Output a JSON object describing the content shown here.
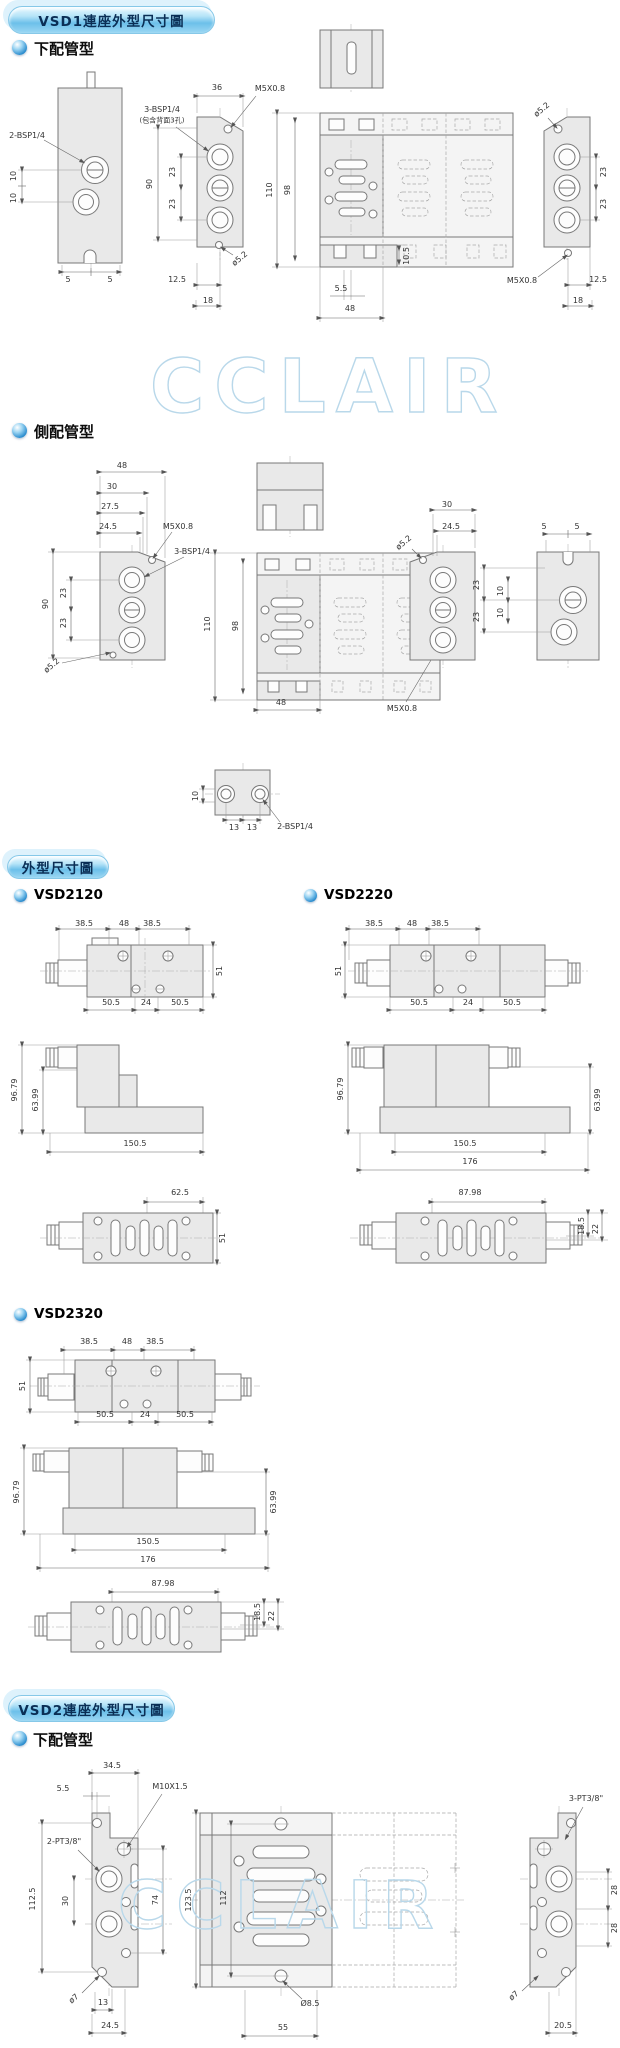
{
  "wm": "CCLAIR",
  "s1": {
    "title": "VSD1連座外型尺寸圖",
    "t_bottom": "下配管型",
    "t_side": "側配管型"
  },
  "s2": {
    "title": "外型尺寸圖",
    "m2120": "VSD2120",
    "m2220": "VSD2220",
    "m2320": "VSD2320"
  },
  "s3": {
    "title": "VSD2連座外型尺寸圖",
    "t_bottom": "下配管型"
  },
  "labels": {
    "m5": "M5X0.8",
    "m10": "M10X1.5",
    "bsp2": "2-BSP1/4",
    "bsp3": "3-BSP1/4",
    "bsp3note": "(包含背面3孔)",
    "pt2": "2-PT3/8\"",
    "pt3": "3-PT3/8\"",
    "dia52": "ø5.2",
    "dia7": "ø7",
    "dia85": "Ø8.5"
  },
  "dims": {
    "v5": "5",
    "v5_5": "5.5",
    "v10": "10",
    "v10_5": "10.5",
    "v12_5": "12.5",
    "v13": "13",
    "v18": "18",
    "v18_5": "18.5",
    "v20_5": "20.5",
    "v22": "22",
    "v23": "23",
    "v24": "24",
    "v24_5": "24.5",
    "v27_5": "27.5",
    "v28": "28",
    "v30": "30",
    "v34_5": "34.5",
    "v36": "36",
    "v38_5": "38.5",
    "v48": "48",
    "v50_5": "50.5",
    "v51": "51",
    "v55": "55",
    "v62_5": "62.5",
    "v63_99": "63.99",
    "v74": "74",
    "v87_98": "87.98",
    "v90": "90",
    "v96_79": "96.79",
    "v98": "98",
    "v110": "110",
    "v112": "112",
    "v112_5": "112.5",
    "v123_5": "123.5",
    "v150_5": "150.5",
    "v176": "176"
  },
  "colors": {
    "accent": "#6cc0ea",
    "watermark": "#b9d8ea",
    "body": "#e9e9e9"
  }
}
